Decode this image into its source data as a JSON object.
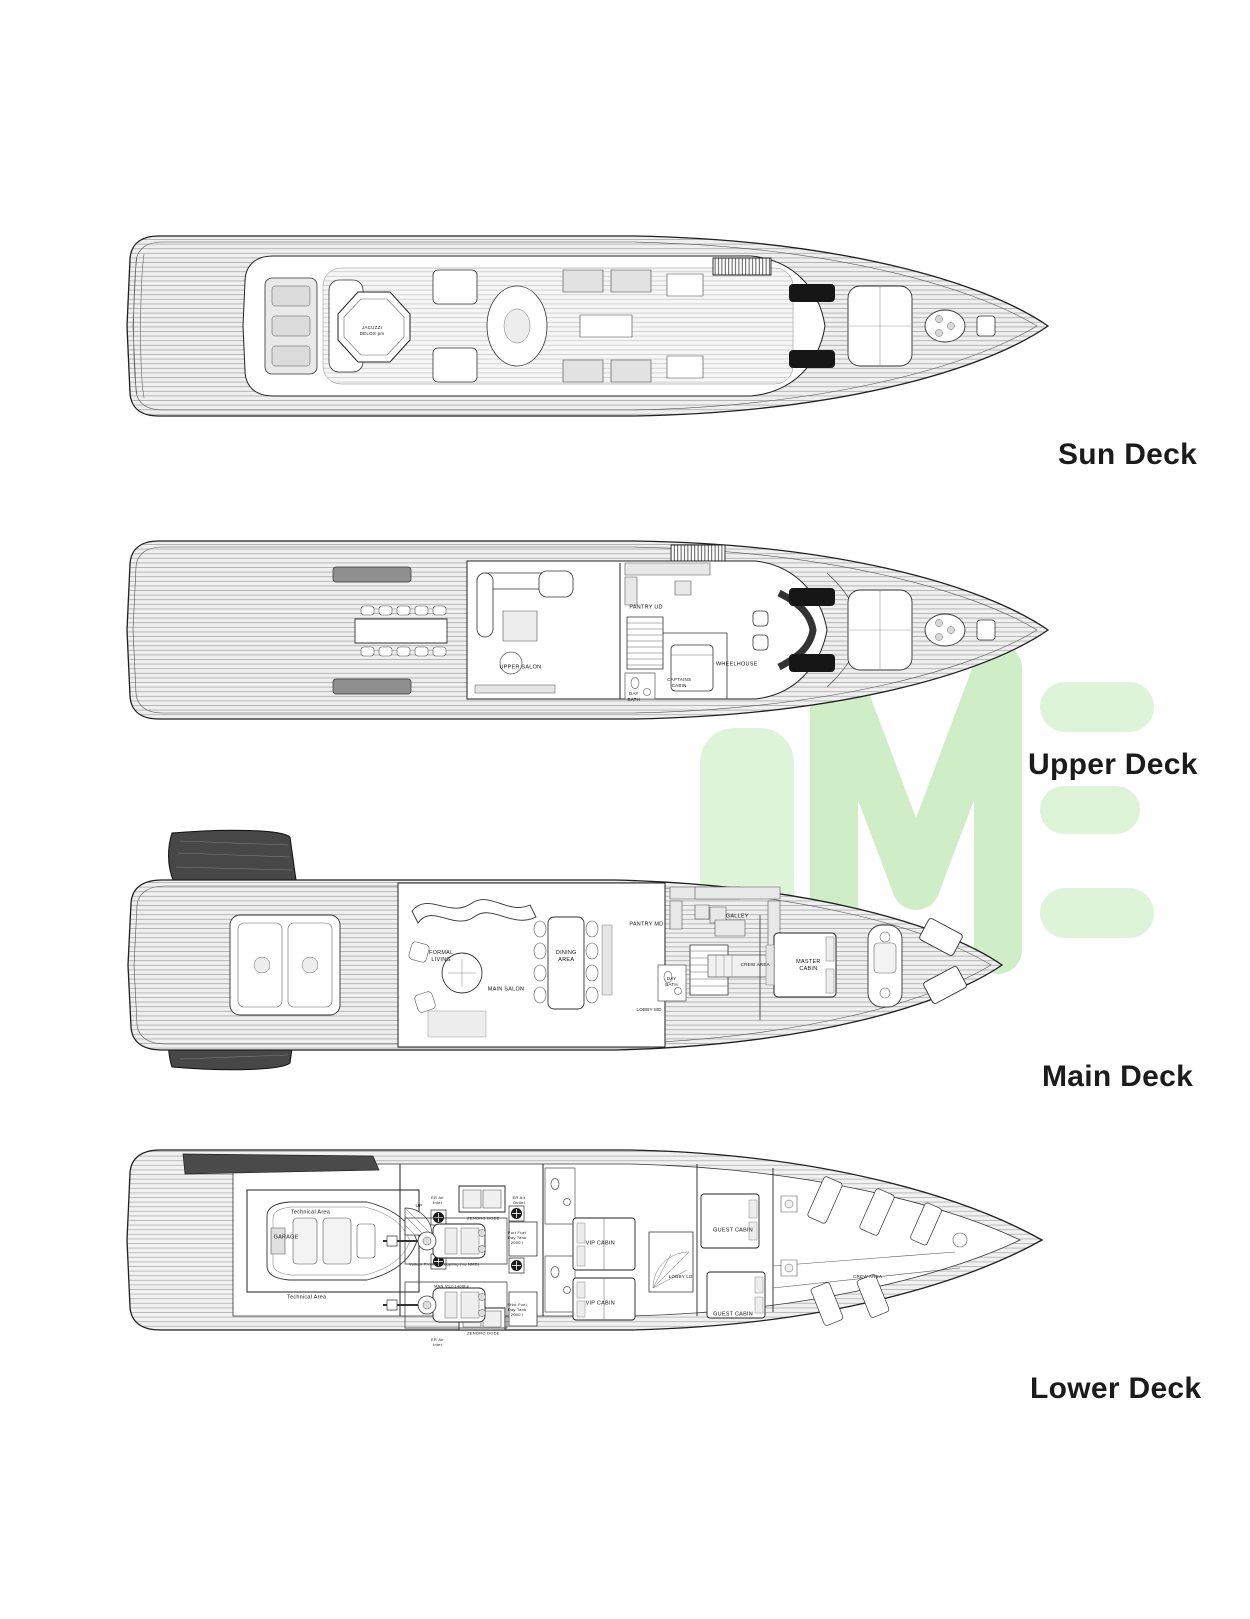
{
  "watermark": {
    "text": "IME",
    "color": "#ddf3d7",
    "color_mid": "#cfeec8"
  },
  "decks": [
    {
      "id": "sun",
      "title": "Sun Deck",
      "labels": [
        {
          "text": "JACUZZI\nDELOS pm",
          "x": 27.2,
          "y": 52.3,
          "size": 4.5
        }
      ]
    },
    {
      "id": "upper",
      "title": "Upper Deck",
      "labels": [
        {
          "text": "UPPER SALON",
          "x": 42.9,
          "y": 69.2
        },
        {
          "text": "PANTRY UD",
          "x": 56.2,
          "y": 38.5
        },
        {
          "text": "DAY\nBATH",
          "x": 54.9,
          "y": 84.1,
          "size": 4.5
        },
        {
          "text": "CAPTAINS\nCABIN",
          "x": 59.7,
          "y": 76.9,
          "size": 4.5
        },
        {
          "text": "WHEELHOUSE",
          "x": 65.8,
          "y": 67.7
        }
      ]
    },
    {
      "id": "main",
      "title": "Main Deck",
      "labels": [
        {
          "text": "FORMAL\nLIVING",
          "x": 36.8,
          "y": 52.8
        },
        {
          "text": "MAIN SALON",
          "x": 44.0,
          "y": 66.0
        },
        {
          "text": "DINING\nAREA",
          "x": 50.7,
          "y": 52.8
        },
        {
          "text": "PANTRY MD",
          "x": 59.6,
          "y": 40.0
        },
        {
          "text": "GALLEY",
          "x": 69.7,
          "y": 36.8
        },
        {
          "text": "CREW AREA",
          "x": 71.7,
          "y": 56.0,
          "size": 4.5
        },
        {
          "text": "DAY\nBATH",
          "x": 62.4,
          "y": 62.8,
          "size": 4.5
        },
        {
          "text": "LOBBY MD",
          "x": 59.9,
          "y": 74.0,
          "size": 4.5
        },
        {
          "text": "MASTER\nCABIN",
          "x": 77.6,
          "y": 56.4
        }
      ]
    },
    {
      "id": "lower",
      "title": "Lower Deck",
      "labels": [
        {
          "text": "Technical Area",
          "x": 20.9,
          "y": 36.5
        },
        {
          "text": "GARAGE",
          "x": 18.3,
          "y": 49.0
        },
        {
          "text": "Technical Area",
          "x": 20.5,
          "y": 79.0
        },
        {
          "text": "UP",
          "x": 32.5,
          "y": 33.0,
          "size": 4.5
        },
        {
          "text": "ER Air\nInlet",
          "x": 34.5,
          "y": 30.0,
          "size": 4
        },
        {
          "text": "ZENORO DODE",
          "x": 39.4,
          "y": 39.0,
          "size": 4
        },
        {
          "text": "ER Air\nOutlet",
          "x": 43.2,
          "y": 30.0,
          "size": 4
        },
        {
          "text": "Port Fuel\nDay Tank\n2000 l",
          "x": 43.0,
          "y": 49.0,
          "size": 4
        },
        {
          "text": "Vulkan Propflex coupling (no NMD)",
          "x": 35.2,
          "y": 62.0,
          "size": 4
        },
        {
          "text": "MAN V12-1400hp",
          "x": 36.0,
          "y": 73.0,
          "size": 4
        },
        {
          "text": "Stbd Fuel\nDay Tank\n2000 l",
          "x": 43.0,
          "y": 85.0,
          "size": 4
        },
        {
          "text": "ZENORO DODE",
          "x": 39.4,
          "y": 96.5,
          "size": 4
        },
        {
          "text": "ER Air\nInlet",
          "x": 34.5,
          "y": 101.0,
          "size": 4
        },
        {
          "text": "VIP CABIN",
          "x": 51.9,
          "y": 52.0
        },
        {
          "text": "VIP CABIN",
          "x": 51.9,
          "y": 82.0
        },
        {
          "text": "LOBBY LD",
          "x": 60.5,
          "y": 68.5,
          "size": 4.5
        },
        {
          "text": "GUEST CABIN",
          "x": 66.1,
          "y": 45.5
        },
        {
          "text": "GUEST CABIN",
          "x": 66.1,
          "y": 87.5
        },
        {
          "text": "CREW AREA",
          "x": 80.5,
          "y": 68.5,
          "size": 4.5
        }
      ]
    }
  ]
}
